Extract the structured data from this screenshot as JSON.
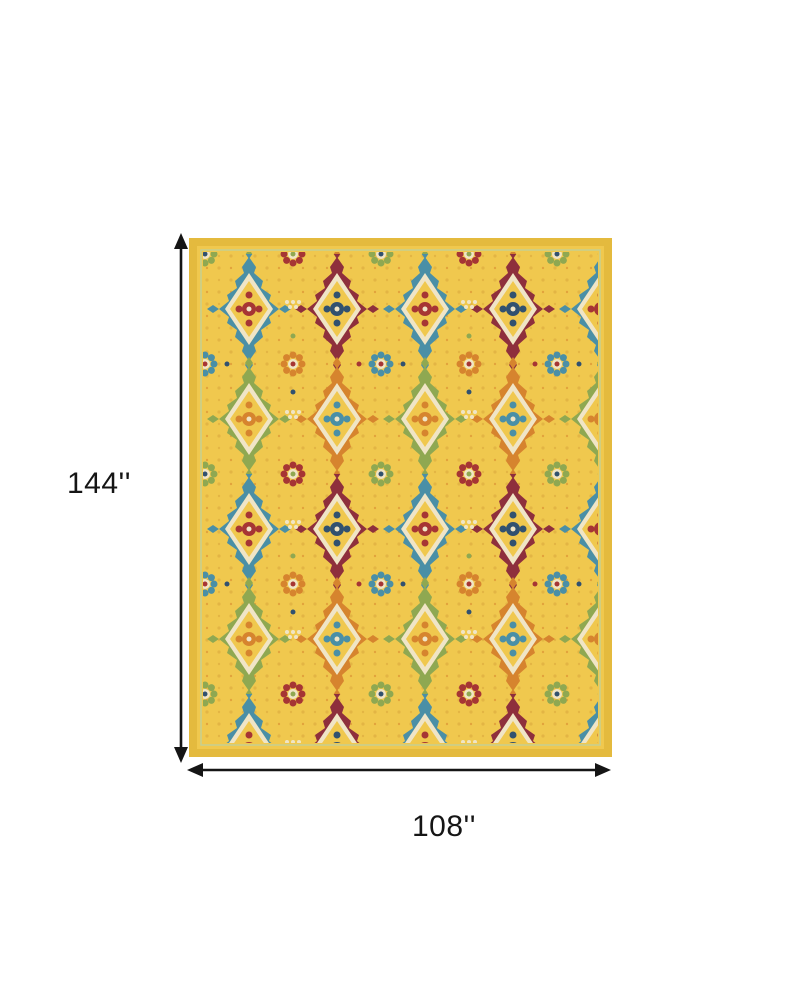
{
  "figure": {
    "background": "#ffffff",
    "ink": "#151515",
    "height_label": "144''",
    "width_label": "108''"
  },
  "rug": {
    "alt": "yellow-multicolor-ornate-medallion-area-rug",
    "palette": {
      "band": "#e4ba3e",
      "field": "#f0c84e",
      "field_speck": "#d8a53b",
      "teal": "#4a8fa6",
      "navy": "#31516f",
      "red": "#a63534",
      "maroon": "#8e2f3c",
      "orange": "#d6842e",
      "green": "#8fa851",
      "cream": "#f0e5c6",
      "lightgreen": "#c6cf92"
    }
  }
}
